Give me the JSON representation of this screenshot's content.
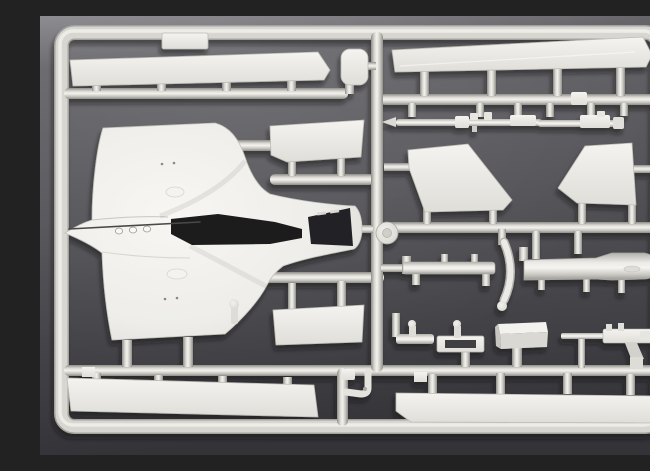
{
  "scene": {
    "type": "photograph",
    "subject": "Injection-molded model aircraft kit sprue (parts tree) of light grey styrene photographed on a dark grey background",
    "text_visible": "none",
    "palette": {
      "background_top": "#84848a",
      "background_mid": "#55555a",
      "background_bottom": "#36363b",
      "plastic_base": "#e9e8e4",
      "plastic_highlight": "#f5f4f0",
      "plastic_shadow": "#9a9993",
      "frame_color": "#d6d5cf",
      "cockpit_opening": "#1b1b1d",
      "part_shadow": "#0e0e10"
    },
    "sprue": {
      "frame_shape": "rounded rectangle",
      "part_count_visible": 23,
      "parts": [
        {
          "name": "fuselage-wing-upper-half",
          "desc": "large one-piece upper fuselage with wing halves, open cockpit aperture, nose pointing left",
          "bbox": [
            24,
            107,
            300,
            218
          ]
        },
        {
          "name": "wing-strip-top-left",
          "desc": "long narrow wing/flap strip",
          "bbox": [
            30,
            36,
            260,
            34
          ]
        },
        {
          "name": "small-rect-part-top",
          "desc": "small rectangular plate on top rail",
          "bbox": [
            122,
            17,
            46,
            16
          ]
        },
        {
          "name": "pod-part",
          "desc": "small rounded pod / bay door",
          "bbox": [
            301,
            33,
            27,
            36
          ]
        },
        {
          "name": "wing-strip-top-right",
          "desc": "long wing strip with angled tip",
          "bbox": [
            352,
            21,
            260,
            35
          ]
        },
        {
          "name": "cannon-rod-left",
          "desc": "slender gun/probe rod with pointed tip",
          "bbox": [
            342,
            96,
            161,
            17
          ]
        },
        {
          "name": "cannon-rod-right",
          "desc": "short slender gun rod",
          "bbox": [
            498,
            95,
            87,
            18
          ]
        },
        {
          "name": "fin-half-left",
          "desc": "tailplane / fin panel, left",
          "bbox": [
            368,
            127,
            104,
            69
          ]
        },
        {
          "name": "fin-half-right",
          "desc": "tailplane / fin panel, right",
          "bbox": [
            518,
            127,
            78,
            62
          ]
        },
        {
          "name": "wheel-disc",
          "desc": "round wheel disc at runner junction",
          "bbox": [
            336,
            206,
            22,
            22
          ]
        },
        {
          "name": "pylon-part",
          "desc": "underwing pylon bar with posts",
          "bbox": [
            362,
            238,
            93,
            30
          ]
        },
        {
          "name": "windscreen-arc",
          "desc": "curved crescent frame piece",
          "bbox": [
            455,
            222,
            18,
            72
          ]
        },
        {
          "name": "drop-tank-half",
          "desc": "drop tank half, fat nose to the right",
          "bbox": [
            484,
            236,
            144,
            30
          ]
        },
        {
          "name": "flap-panel-upper",
          "desc": "trapezoid flap panel right of fuselage",
          "bbox": [
            230,
            104,
            95,
            42
          ]
        },
        {
          "name": "flap-panel-lower",
          "desc": "trapezoid flap panel lower right of fuselage",
          "bbox": [
            233,
            289,
            92,
            40
          ]
        },
        {
          "name": "wing-strip-bottom-left",
          "desc": "long lower-wing strip",
          "bbox": [
            27,
            362,
            251,
            40
          ]
        },
        {
          "name": "wing-strip-bottom-right",
          "desc": "long lower-wing strip",
          "bbox": [
            356,
            377,
            262,
            31
          ]
        },
        {
          "name": "t-fitting",
          "desc": "small T-shaped fitting",
          "bbox": [
            352,
            297,
            42,
            31
          ]
        },
        {
          "name": "boarding-ladder",
          "desc": "small ladder frame with open slot",
          "bbox": [
            397,
            308,
            47,
            44
          ]
        },
        {
          "name": "equipment-box",
          "desc": "small rectangular box part",
          "bbox": [
            458,
            306,
            50,
            45
          ]
        },
        {
          "name": "machine-gun",
          "desc": "machine-gun shaped part with lower strut",
          "bbox": [
            521,
            307,
            97,
            46
          ]
        },
        {
          "name": "l-shaped-pipe",
          "desc": "small elbow / pitot pipe",
          "bbox": [
            302,
            353,
            30,
            27
          ]
        },
        {
          "name": "small-stub",
          "desc": "tiny ball-headed stub",
          "bbox": [
            189,
            283,
            10,
            25
          ]
        }
      ]
    }
  }
}
